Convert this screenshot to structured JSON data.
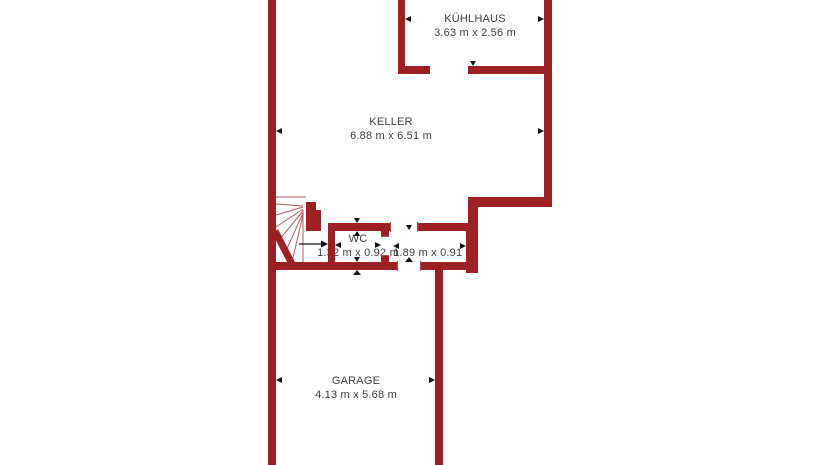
{
  "floorplan": {
    "rooms": [
      {
        "id": "kuehlhaus",
        "name": "KÜHLHAUS",
        "dimensions": "3.63 m x 2.56 m"
      },
      {
        "id": "keller",
        "name": "KELLER",
        "dimensions": "6.88 m x 6.51 m"
      },
      {
        "id": "wc",
        "name": "WC",
        "dimensions": "1.32 m x 0.92 m"
      },
      {
        "id": "flur",
        "name": "",
        "dimensions": "1.89 m x 0.91 m"
      },
      {
        "id": "garage",
        "name": "GARAGE",
        "dimensions": "4.13 m x 5.68 m"
      }
    ],
    "icons": [
      {
        "name": "stair-direction-arrow-icon",
        "shape": "black right-pointing arrow on stair walk line"
      },
      {
        "name": "dimension-marker-icon",
        "shape": "small black triangle on wall face"
      }
    ],
    "colors": {
      "wall": "#9d2023",
      "stair_lines": "#b35c5c",
      "door_lines": "#ad4a4a",
      "dimension_marker": "#141414",
      "label_text": "#3d3d3d",
      "background": "#ffffff"
    }
  }
}
